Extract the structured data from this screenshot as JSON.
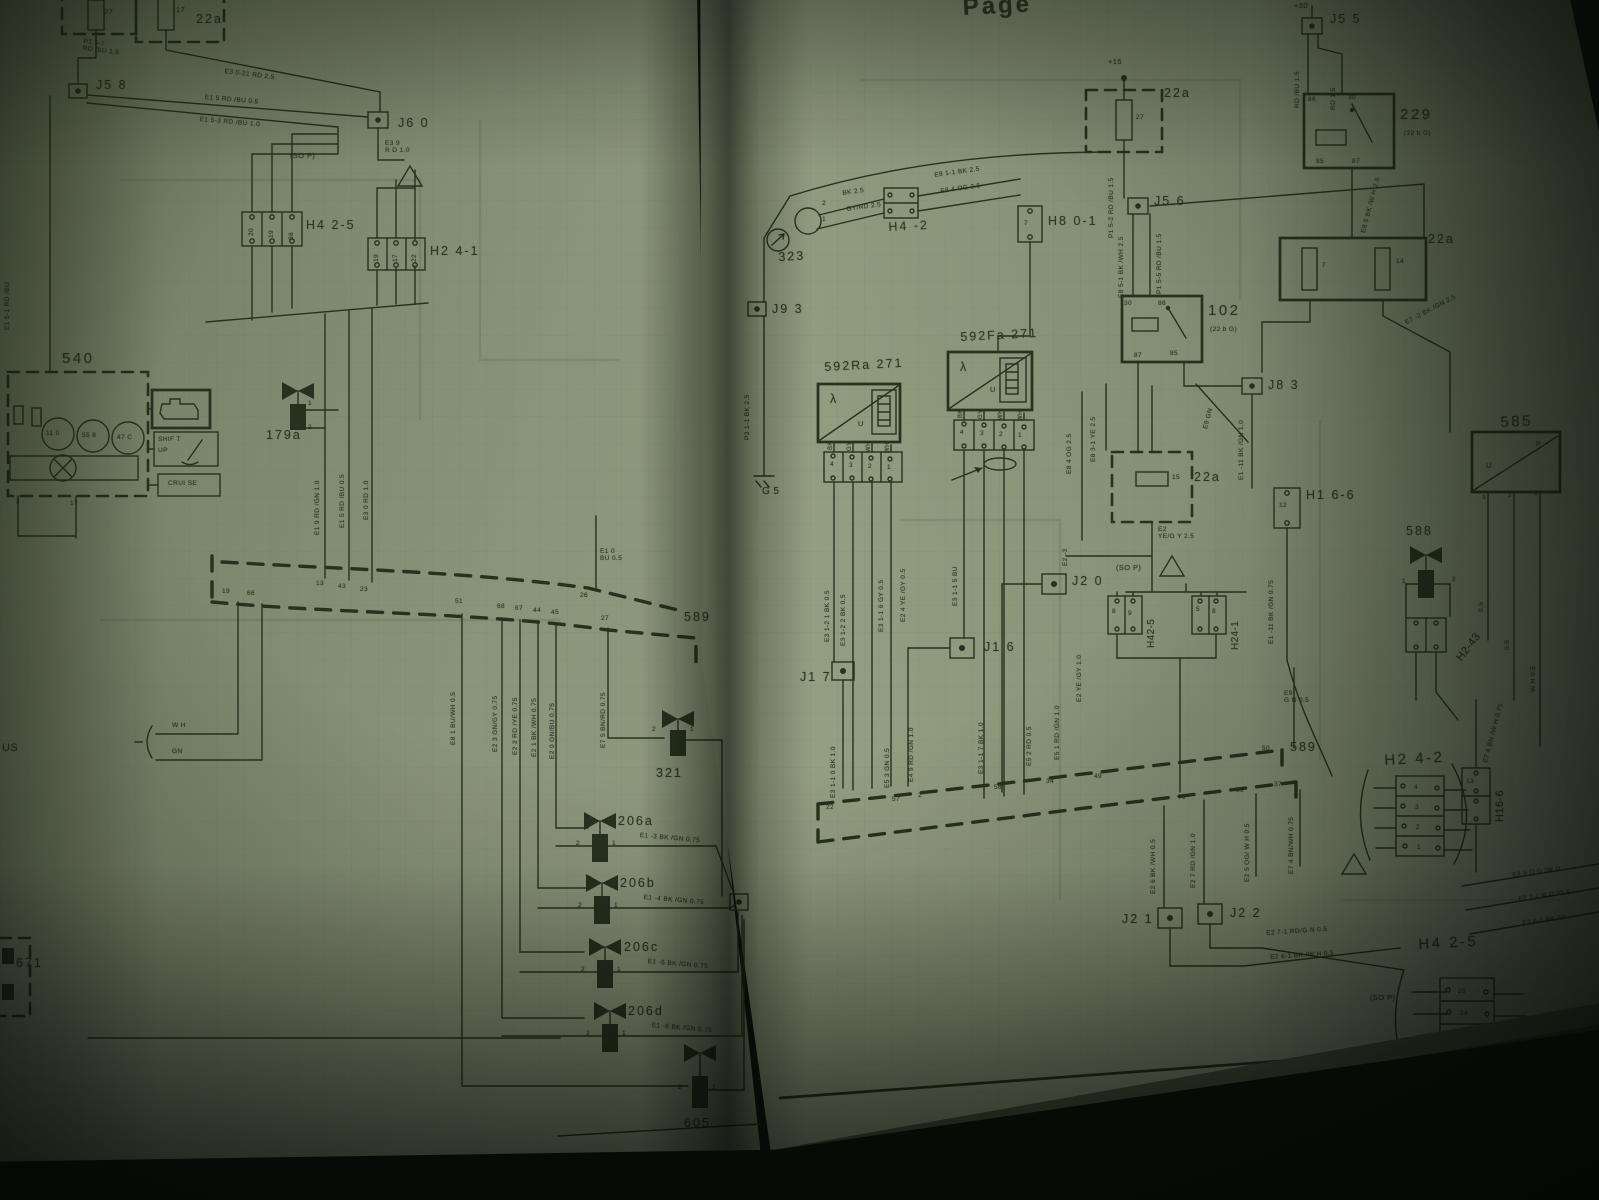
{
  "colors": {
    "paper": "#8d977b",
    "ink": "#26311f"
  },
  "lp": {
    "fuse27": "27",
    "fuse17": "17",
    "fusebox_22a": "22a",
    "w_p157": "P1 5-7\nRD /BU  1.5",
    "w_e3021": "E3 0-21   RD   2.5",
    "j58": "J5 8",
    "w_e15": "E1 5   RD /BU   0.5",
    "w_e153": "E1 5-3   RD /BU   1.0",
    "j60": "J6 0",
    "w_e39": "E3 9\nR D   1.0",
    "sop": "(SO P)",
    "h425": "H4 2-5",
    "h425_pins": [
      "20",
      "19",
      "36"
    ],
    "h241": "H2 4-1",
    "h241_pins": [
      "19",
      "17",
      "22"
    ],
    "c540": "540",
    "g1": "11 0",
    "g2": "55 8",
    "g3": "47 C",
    "shift1": "SHIF T",
    "shift2": "UP",
    "cruise": "CRUI  SE",
    "c540_pin2": "2",
    "c540_pin17": "17",
    "w_left": "E1 5-1  RD /BU",
    "c179a": "179a",
    "p1": "1",
    "p2": "2",
    "w_e19": "E1 9   RD /GN   1.0",
    "w_e15v": "E1 5   RD /BU   0.5",
    "w_e30": "E3 0   RD   1.0",
    "pins_top": [
      "13",
      "43",
      "23"
    ],
    "w_e10": "E1 0\nBU   0.5",
    "pin26": "26",
    "c589": "589",
    "pins_dash": [
      "19",
      "66",
      "51",
      "68",
      "67",
      "44",
      "45",
      "27"
    ],
    "w_e81": "E8 1   BU/WH   0.5",
    "w_e23": "E2 3   GN/GY   0.75",
    "w_e22": "E2 2   RD /YE   0.75",
    "w_e21": "E2 1   BK /WH   0.75",
    "w_e20": "E2 0   GN/BU   0.75",
    "w_e75": "E7 5   BN/RD   0.75",
    "bus_wh": "W H",
    "bus_gn": "GN",
    "bus_stub": "US",
    "c671": "671",
    "c321": "321",
    "c206a": "206a",
    "w_e13": "E1 -3   BK /GN   0.75",
    "c206b": "206b",
    "w_e14": "E1 -4   BK /GN   0.75",
    "c206c": "206c",
    "w_e15b": "E1 -5   BK /GN   0.75",
    "c206d": "206d",
    "w_e16": "E1 -6   BK /GN   0.75",
    "c605": "605"
  },
  "rp": {
    "header": "Page",
    "plus15": "+15",
    "fusebox1": "22a",
    "fuse27": "27",
    "w_p152": "P1 5-2   RD /BU   1.5",
    "j56": "J5 6",
    "w_e851": "E8 5-1   BK /WH   2.5",
    "w_p155": "P1 5-5   RD /BU   1.5",
    "c102": "102",
    "c102_sub": "(22 b G)",
    "p30": "30",
    "p86": "86",
    "p87": "87",
    "p85": "85",
    "plus30": "+30",
    "j55": "J5 5",
    "w_rdbu": "RD /BU   1.5",
    "w_rd": "RD   1.5",
    "c229": "229",
    "c229_sub": "(22 b G)",
    "w_e85": "E8 5   BK /W H   2.5",
    "fusebox2": "22a",
    "fuse7": "7",
    "fuse14": "14",
    "w_e72": "E7 -2   BK /GN   2.5",
    "c323": "323",
    "p2": "2",
    "p1": "1",
    "p3": "3",
    "p7": "7",
    "p12": "12",
    "p13": "13",
    "w_bk": "BK   2.5",
    "w_gyrd": "GY/RD  2.5",
    "h4_2": "H4  -2",
    "w_e811": "E8 1-1   BK   2.5",
    "w_e84": "E8 4   OG   2.5",
    "h801": "H8 0-1",
    "j93": "J9 3",
    "g5": "G 5",
    "w_p311": "P3 1-1   BK   2.5",
    "c592ra": "592Ra   271",
    "c592fa": "592Fa   271",
    "lambda": "λ",
    "u": "U",
    "p_p": "P",
    "pins4321": [
      "4",
      "3",
      "2",
      "1"
    ],
    "wc_bk": "BK",
    "wc_gy": "GY",
    "wc_wh": "WH",
    "w_e3121": "E3 1-2 1   BK   0.5",
    "w_e3122": "E3 1-2 2   BK   0.5",
    "w_e3116": "E3 1-1 6   GY   0.5",
    "w_e24": "E2 4   YE /GY   0.5",
    "w_e3115": "E3 1-1 5   BU",
    "w_e2m3": "E2 -3",
    "w_e3110": "E3 1-1 0   BK   1.0",
    "w_e53": "E5 3   GN   0.5",
    "w_e49": "E4 9   RD /GN   1.0",
    "w_e3117": "E3 1-1 7   BK   1.0",
    "w_e52": "E5 2   RD   0.5",
    "w_e51": "E5 1   RD /GN   1.0",
    "w_e2": "E2   YE /GY   1.0",
    "j17": "J1 7",
    "j16": "J1 6",
    "j20": "J2 0",
    "fusebox3": "22a",
    "fuse15": "15",
    "w_e2y": "E2\nYE/G Y   2.5",
    "w_e831": "E8 3-1   YE   2.5",
    "w_e84b": "E8 4   OG   2.5",
    "w_e9": "E9   GN",
    "sop": "(SO P)",
    "h42_5": "H42-5",
    "h42_5_pins": [
      "8",
      "9"
    ],
    "h24_1": "H24-1",
    "h24_1_pins": [
      "5",
      "8"
    ],
    "j83": "J8 3",
    "h166": "H1 6-6",
    "w_e111a": "E1 -11   BK /GN   1.0",
    "w_e111b": "E1 -11   BK /GN   0.75",
    "c588": "588",
    "h243": "H2-43",
    "c585": "585",
    "w_05": "0.5",
    "w_wh05": "W H   0.5",
    "c589": "589",
    "w_e9b": "E9\nG N   0.5",
    "pins_589": [
      "22",
      "57",
      "2",
      "58",
      "34",
      "49",
      "50",
      "70",
      "59",
      "37"
    ],
    "w_e26": "E2 6   BK /WH   0.5",
    "w_e27": "E2 7   RD /GN   1.0",
    "w_e25": "E2 5   OG/ W H   0.5",
    "w_e74": "E7 4   BN/WH   0.75",
    "j21": "J2 1",
    "j22": "J2 2",
    "w_e271": "E2 7-1   RD/G N   0.5",
    "w_e261": "E2 6-1   BK /W H   0.5",
    "h242": "H2 4-2",
    "h166b": "H16-6",
    "w_e74b": "E7 4   BN /W H   0.75",
    "w_e25b": "E2 5   O G /W H",
    "w_e271b": "E2 7-1   R D /G 1",
    "w_e261b": "E2 6-1   BK /W",
    "sop2": "(SO P)",
    "h425": "H4 2-5",
    "h425_pins": [
      "26",
      "24",
      "23",
      "22"
    ],
    "pagenum": "9-5"
  }
}
